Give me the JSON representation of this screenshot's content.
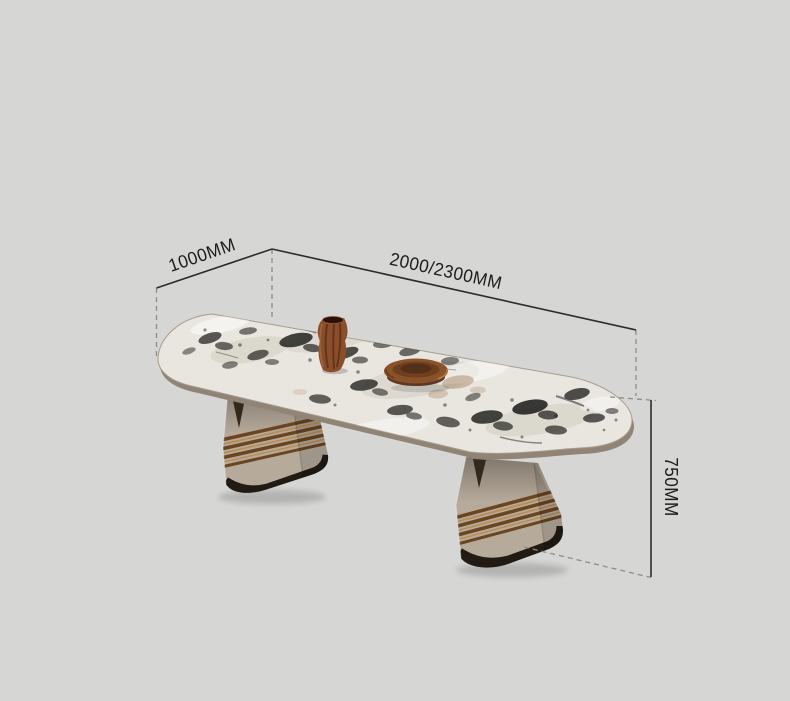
{
  "dimensions": {
    "depth": "1000MM",
    "length": "2000/2300MM",
    "height": "750MM"
  },
  "colors": {
    "bg": "#d6d6d4",
    "dim-line": "#2c2c2c",
    "dash-line": "#8d8d8b",
    "label-text": "#1c1c1c",
    "marble-base": "#e9e6df",
    "marble-shade": "#c3bcb0",
    "marble-dark": "#242421",
    "marble-stain": "#9c7148",
    "table-edge": "#8f8475",
    "leg": "#b6aa9b",
    "brass-dark": "#6b4420",
    "brass-light": "#b88c52",
    "plinth": "#211b14",
    "notch": "#33281b",
    "vase-wood": "#8a4e2b",
    "vase-dark": "#46210f",
    "tray-wood": "#8a5229",
    "tray-dark": "#54301a"
  }
}
